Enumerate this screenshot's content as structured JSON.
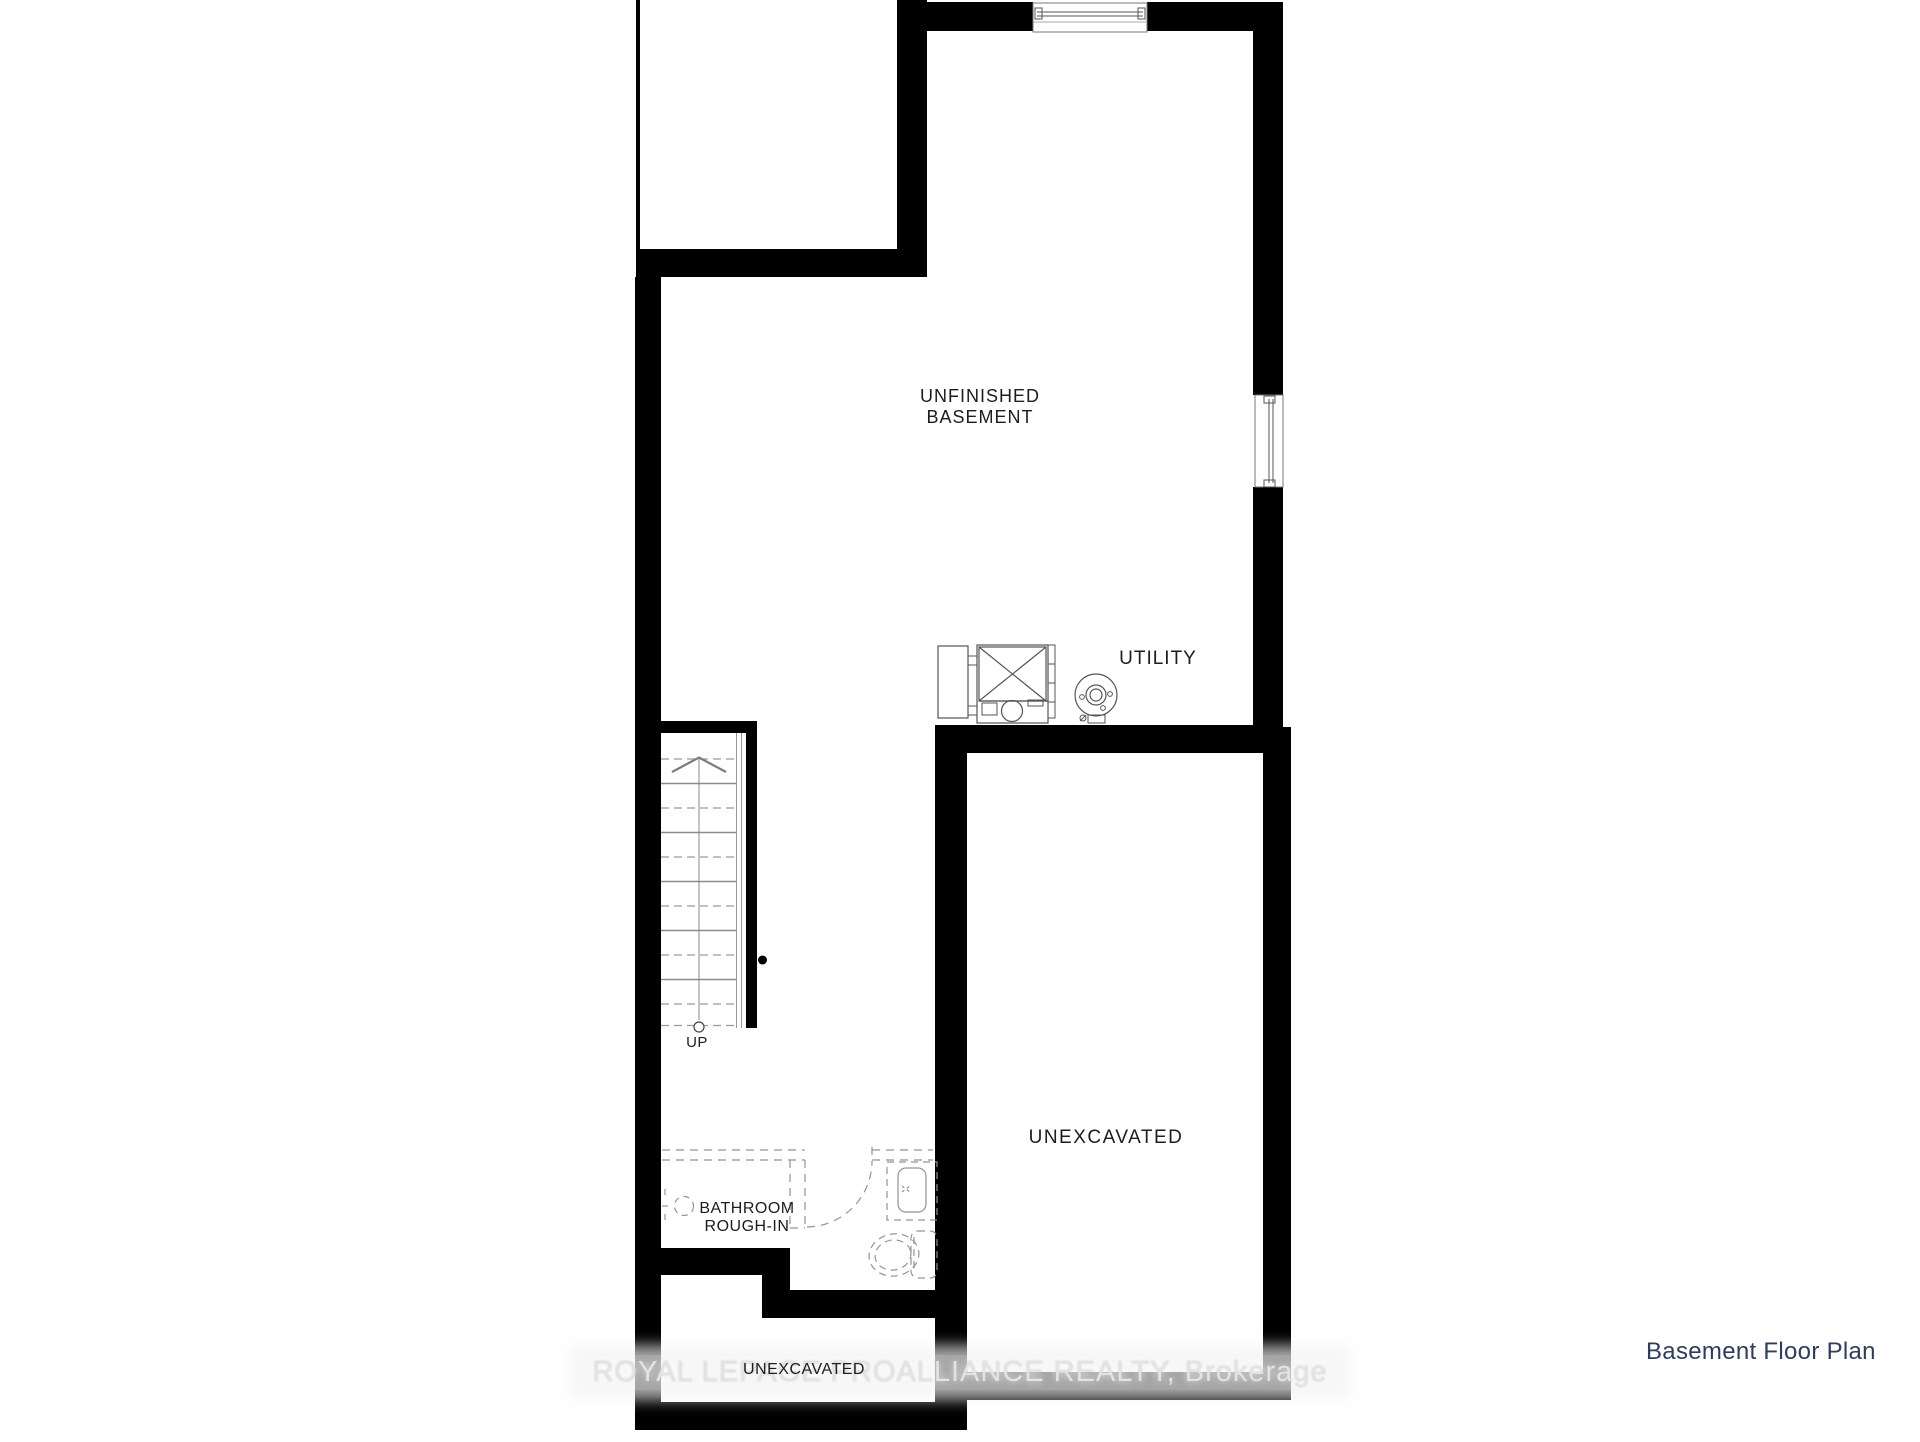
{
  "plan": {
    "footer_title": "Basement Floor Plan",
    "watermark": "ROYAL LEPAGE PROALLIANCE REALTY, Brokerage",
    "labels": {
      "main_room_line1": "UNFINISHED",
      "main_room_line2": "BASEMENT",
      "utility": "UTILITY",
      "stairs_up": "UP",
      "bathroom_line1": "BATHROOM",
      "bathroom_line2": "ROUGH-IN",
      "unexcavated_main": "UNEXCAVATED",
      "unexcavated_lower": "UNEXCAVATED"
    },
    "colors": {
      "wall": "#000000",
      "label_text": "#1d1d1d",
      "footer_title_text": "#2e3d5c",
      "thin_line": "#666666",
      "dashed_line": "#949494",
      "watermark_text": "#e3e3e3"
    },
    "icons": [
      "furnace-icon",
      "water-heater-icon",
      "toilet-icon",
      "vanity-sink-icon",
      "plumbing-rough-in-icon",
      "stairs-up-arrow-icon",
      "window-icon-top",
      "window-icon-right"
    ]
  }
}
